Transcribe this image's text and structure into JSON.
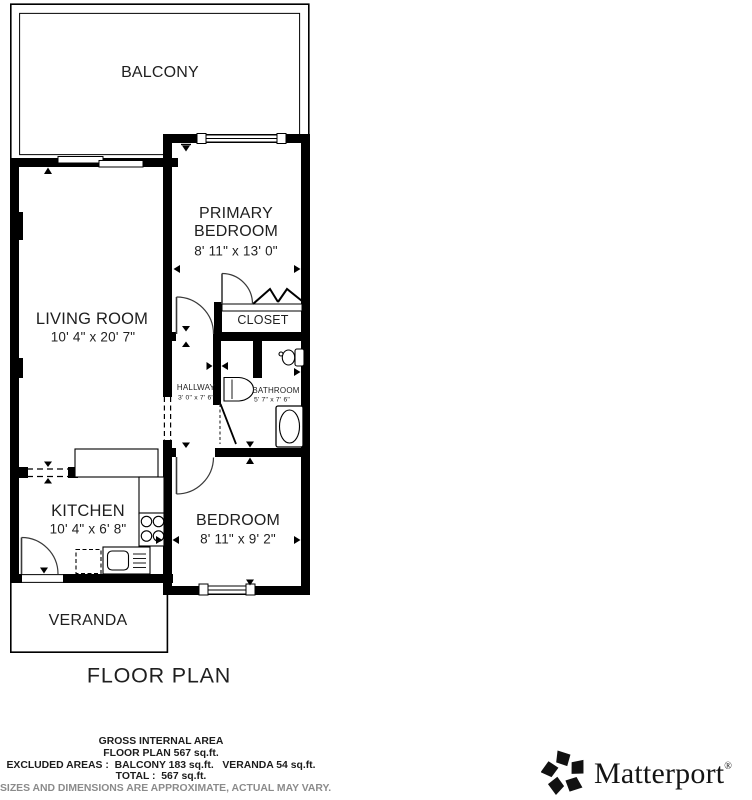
{
  "page": {
    "title": "FLOOR PLAN"
  },
  "rooms": {
    "balcony": {
      "label": "BALCONY"
    },
    "primary_bedroom": {
      "line1": "PRIMARY",
      "line2": "BEDROOM",
      "dims": "8' 11\" x 13' 0\""
    },
    "living_room": {
      "label": "LIVING ROOM",
      "dims": "10' 4\" x 20' 7\""
    },
    "closet": {
      "label": "CLOSET"
    },
    "hallway": {
      "label": "HALLWAY",
      "dims": "3' 0\" x 7' 6\""
    },
    "bathroom": {
      "label": "BATHROOM",
      "dims": "5' 7\" x 7' 6\""
    },
    "kitchen": {
      "label": "KITCHEN",
      "dims": "10' 4\" x 6' 8\""
    },
    "bedroom": {
      "label": "BEDROOM",
      "dims": "8' 11\" x 9' 2\""
    },
    "veranda": {
      "label": "VERANDA"
    }
  },
  "footer": {
    "gross_internal_area": "GROSS INTERNAL AREA",
    "floor_plan_area": "FLOOR PLAN 567 sq.ft.",
    "excluded_areas": "EXCLUDED AREAS :  BALCONY 183 sq.ft.   VERANDA 54 sq.ft.",
    "total": "TOTAL :  567 sq.ft.",
    "disclaimer": "SIZES AND DIMENSIONS ARE APPROXIMATE, ACTUAL MAY VARY."
  },
  "branding": {
    "name": "Matterport",
    "registered_mark": "®"
  },
  "colors": {
    "wall": "#000000",
    "label_text": "#1f1f1f",
    "disclaimer_text": "#8b8b8b"
  }
}
